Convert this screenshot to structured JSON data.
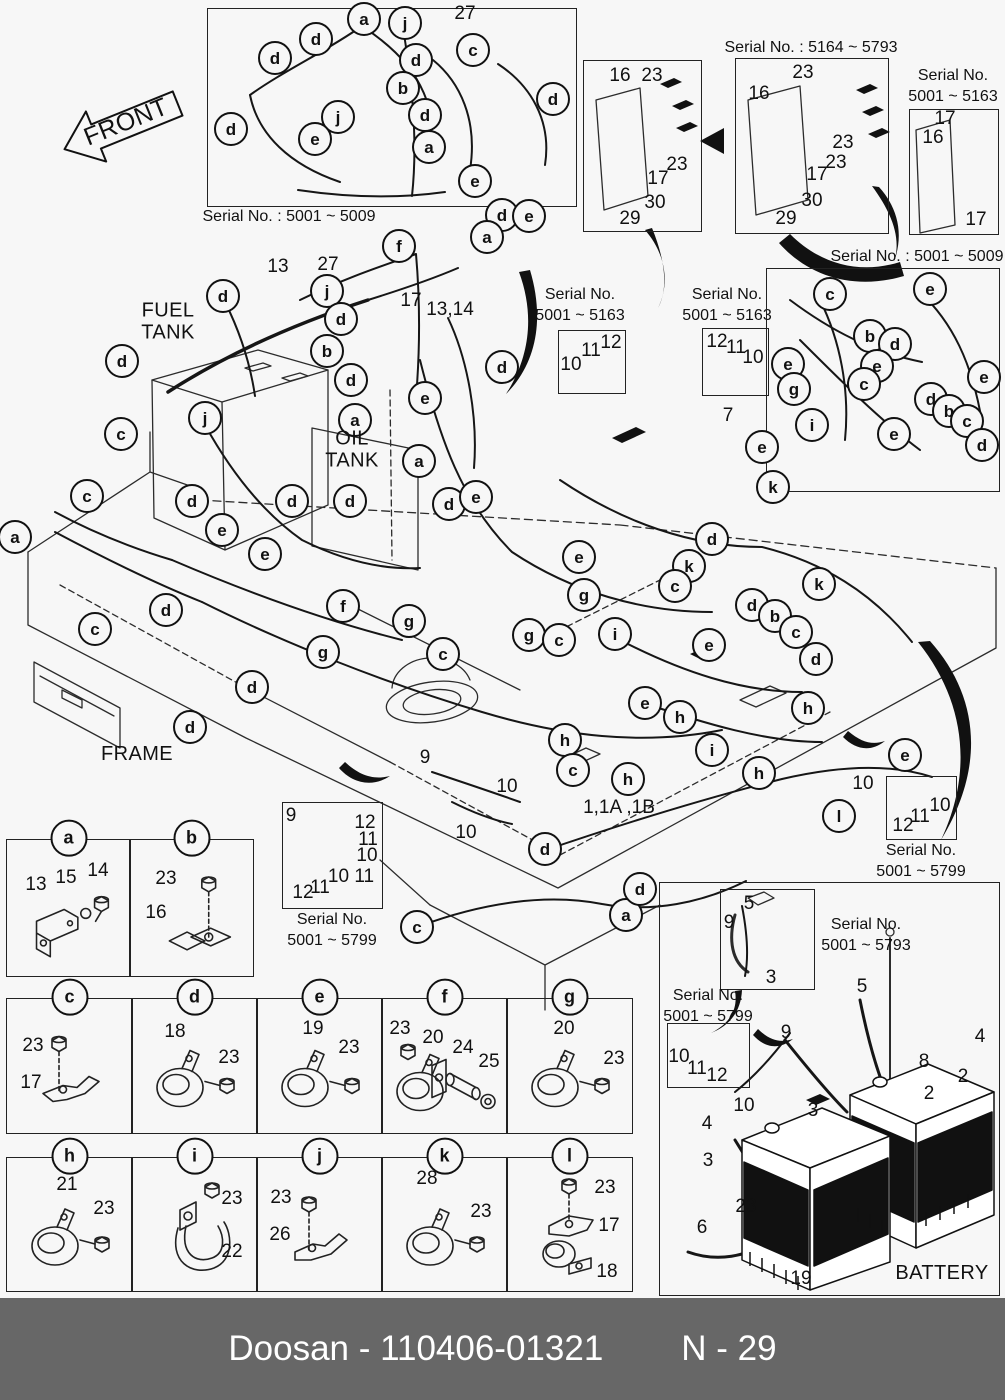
{
  "page": {
    "width": 1005,
    "height": 1400,
    "background": "#f7f7f7",
    "line_color": "#1a1a1a"
  },
  "footer": {
    "brand": "Doosan",
    "figure_number": "110406-01321",
    "left_text": "Doosan - 110406-01321",
    "page_code": "N - 29",
    "bar_color": "#676767",
    "text_color": "#ffffff"
  },
  "area_labels": [
    {
      "id": "front",
      "lines": [
        "FRONT"
      ],
      "x": 126,
      "y": 122,
      "size": 25,
      "rotate": -22
    },
    {
      "id": "fuel-tank",
      "lines": [
        "FUEL",
        "TANK"
      ],
      "x": 168,
      "y": 322,
      "size": 20
    },
    {
      "id": "oil-tank",
      "lines": [
        "OIL",
        "TANK"
      ],
      "x": 352,
      "y": 450,
      "size": 20
    },
    {
      "id": "frame",
      "lines": [
        "FRAME"
      ],
      "x": 137,
      "y": 754,
      "size": 20
    },
    {
      "id": "battery",
      "lines": [
        "BATTERY"
      ],
      "x": 942,
      "y": 1273,
      "size": 20
    }
  ],
  "serial_boxes": [
    {
      "id": "top-left-5009",
      "box": [
        207,
        8,
        368,
        197
      ],
      "caption_lines": [
        "Serial No. : 5001 ~ 5009"
      ],
      "caption_xy": [
        289,
        207
      ]
    },
    {
      "id": "plate-early",
      "box": [
        583,
        60,
        117,
        170
      ]
    },
    {
      "id": "plate-5164-5793",
      "box": [
        735,
        58,
        152,
        174
      ],
      "caption_lines": [
        "Serial No. : 5164 ~ 5793"
      ],
      "caption_xy": [
        811,
        38
      ]
    },
    {
      "id": "top-right-5163",
      "box": [
        909,
        109,
        88,
        124
      ],
      "caption_lines": [
        "Serial No.",
        "5001 ~ 5163"
      ],
      "caption_xy": [
        953,
        66
      ]
    },
    {
      "id": "mid-5163-left",
      "box": [
        558,
        330,
        66,
        62
      ],
      "caption_lines": [
        "Serial No.",
        "5001 ~ 5163"
      ],
      "caption_xy": [
        580,
        285
      ]
    },
    {
      "id": "mid-5163-right",
      "box": [
        702,
        328,
        65,
        66
      ],
      "caption_lines": [
        "Serial No.",
        "5001 ~ 5163"
      ],
      "caption_xy": [
        727,
        285
      ]
    },
    {
      "id": "right-5009",
      "box": [
        766,
        268,
        232,
        222
      ],
      "caption_lines": [
        "Serial No. : 5001 ~ 5009"
      ],
      "caption_xy": [
        917,
        247
      ]
    },
    {
      "id": "center-5799",
      "box": [
        282,
        802,
        99,
        105
      ],
      "caption_lines": [
        "Serial No.",
        "5001 ~ 5799"
      ],
      "caption_xy": [
        332,
        910
      ]
    },
    {
      "id": "right-5799",
      "box": [
        886,
        776,
        69,
        62
      ],
      "caption_lines": [
        "Serial No.",
        "5001 ~ 5799"
      ],
      "caption_xy": [
        921,
        841
      ]
    },
    {
      "id": "battery-outer",
      "box": [
        659,
        882,
        339,
        412
      ]
    },
    {
      "id": "battery-inner-5793",
      "box": [
        720,
        889,
        93,
        99
      ],
      "caption_lines": [
        "Serial No.",
        "5001 ~ 5793"
      ],
      "caption_xy": [
        866,
        915
      ]
    },
    {
      "id": "battery-5799",
      "box": [
        667,
        1023,
        81,
        63
      ],
      "caption_lines": [
        "Serial No.",
        "5001 ~ 5799"
      ],
      "caption_xy": [
        708,
        986
      ]
    }
  ],
  "callouts": [
    {
      "t": "a",
      "x": 362,
      "y": 17
    },
    {
      "t": "j",
      "x": 403,
      "y": 21
    },
    {
      "t": "d",
      "x": 314,
      "y": 37
    },
    {
      "t": "c",
      "x": 471,
      "y": 48
    },
    {
      "t": "d",
      "x": 273,
      "y": 56
    },
    {
      "t": "d",
      "x": 414,
      "y": 58
    },
    {
      "t": "b",
      "x": 401,
      "y": 86
    },
    {
      "t": "d",
      "x": 551,
      "y": 97
    },
    {
      "t": "d",
      "x": 423,
      "y": 113
    },
    {
      "t": "j",
      "x": 336,
      "y": 115
    },
    {
      "t": "d",
      "x": 229,
      "y": 127
    },
    {
      "t": "e",
      "x": 313,
      "y": 137
    },
    {
      "t": "a",
      "x": 427,
      "y": 145
    },
    {
      "t": "e",
      "x": 473,
      "y": 179
    },
    {
      "t": "d",
      "x": 500,
      "y": 213
    },
    {
      "t": "e",
      "x": 527,
      "y": 214
    },
    {
      "t": "a",
      "x": 485,
      "y": 235
    },
    {
      "t": "f",
      "x": 397,
      "y": 244
    },
    {
      "t": "j",
      "x": 325,
      "y": 289
    },
    {
      "t": "d",
      "x": 221,
      "y": 294
    },
    {
      "t": "d",
      "x": 339,
      "y": 317
    },
    {
      "t": "b",
      "x": 325,
      "y": 349
    },
    {
      "t": "d",
      "x": 120,
      "y": 359
    },
    {
      "t": "d",
      "x": 349,
      "y": 378
    },
    {
      "t": "d",
      "x": 500,
      "y": 365
    },
    {
      "t": "e",
      "x": 423,
      "y": 396
    },
    {
      "t": "j",
      "x": 203,
      "y": 416
    },
    {
      "t": "a",
      "x": 353,
      "y": 418
    },
    {
      "t": "c",
      "x": 119,
      "y": 432
    },
    {
      "t": "c",
      "x": 828,
      "y": 292
    },
    {
      "t": "e",
      "x": 928,
      "y": 287
    },
    {
      "t": "b",
      "x": 868,
      "y": 334
    },
    {
      "t": "d",
      "x": 893,
      "y": 342
    },
    {
      "t": "e",
      "x": 786,
      "y": 362
    },
    {
      "t": "e",
      "x": 875,
      "y": 364
    },
    {
      "t": "e",
      "x": 982,
      "y": 375
    },
    {
      "t": "g",
      "x": 792,
      "y": 387
    },
    {
      "t": "c",
      "x": 862,
      "y": 382
    },
    {
      "t": "d",
      "x": 929,
      "y": 397
    },
    {
      "t": "b",
      "x": 947,
      "y": 409
    },
    {
      "t": "c",
      "x": 965,
      "y": 419
    },
    {
      "t": "i",
      "x": 810,
      "y": 423
    },
    {
      "t": "e",
      "x": 892,
      "y": 432
    },
    {
      "t": "d",
      "x": 980,
      "y": 443
    },
    {
      "t": "a",
      "x": 13,
      "y": 535
    },
    {
      "t": "c",
      "x": 85,
      "y": 494
    },
    {
      "t": "d",
      "x": 190,
      "y": 499
    },
    {
      "t": "d",
      "x": 290,
      "y": 499
    },
    {
      "t": "e",
      "x": 220,
      "y": 528
    },
    {
      "t": "e",
      "x": 263,
      "y": 552
    },
    {
      "t": "d",
      "x": 164,
      "y": 608
    },
    {
      "t": "c",
      "x": 93,
      "y": 627
    },
    {
      "t": "g",
      "x": 321,
      "y": 650
    },
    {
      "t": "f",
      "x": 341,
      "y": 604
    },
    {
      "t": "d",
      "x": 250,
      "y": 685
    },
    {
      "t": "d",
      "x": 188,
      "y": 725
    },
    {
      "t": "a",
      "x": 417,
      "y": 459
    },
    {
      "t": "d",
      "x": 447,
      "y": 502
    },
    {
      "t": "e",
      "x": 474,
      "y": 495
    },
    {
      "t": "d",
      "x": 348,
      "y": 499
    },
    {
      "t": "g",
      "x": 407,
      "y": 619
    },
    {
      "t": "g",
      "x": 527,
      "y": 633
    },
    {
      "t": "g",
      "x": 582,
      "y": 593
    },
    {
      "t": "e",
      "x": 577,
      "y": 555
    },
    {
      "t": "c",
      "x": 441,
      "y": 652
    },
    {
      "t": "c",
      "x": 557,
      "y": 638
    },
    {
      "t": "i",
      "x": 613,
      "y": 632
    },
    {
      "t": "h",
      "x": 563,
      "y": 738
    },
    {
      "t": "c",
      "x": 571,
      "y": 768
    },
    {
      "t": "e",
      "x": 760,
      "y": 445
    },
    {
      "t": "k",
      "x": 771,
      "y": 485
    },
    {
      "t": "d",
      "x": 710,
      "y": 537
    },
    {
      "t": "k",
      "x": 687,
      "y": 564
    },
    {
      "t": "c",
      "x": 673,
      "y": 584
    },
    {
      "t": "k",
      "x": 817,
      "y": 582
    },
    {
      "t": "d",
      "x": 750,
      "y": 603
    },
    {
      "t": "b",
      "x": 773,
      "y": 614
    },
    {
      "t": "c",
      "x": 794,
      "y": 630
    },
    {
      "t": "d",
      "x": 814,
      "y": 657
    },
    {
      "t": "e",
      "x": 707,
      "y": 643
    },
    {
      "t": "e",
      "x": 643,
      "y": 701
    },
    {
      "t": "h",
      "x": 678,
      "y": 715
    },
    {
      "t": "h",
      "x": 806,
      "y": 706
    },
    {
      "t": "i",
      "x": 710,
      "y": 748
    },
    {
      "t": "h",
      "x": 757,
      "y": 771
    },
    {
      "t": "h",
      "x": 626,
      "y": 777
    },
    {
      "t": "e",
      "x": 903,
      "y": 753
    },
    {
      "t": "l",
      "x": 837,
      "y": 814
    },
    {
      "t": "c",
      "x": 415,
      "y": 925
    },
    {
      "t": "a",
      "x": 624,
      "y": 913
    },
    {
      "t": "d",
      "x": 543,
      "y": 847
    },
    {
      "t": "d",
      "x": 638,
      "y": 887
    }
  ],
  "part_numbers": [
    {
      "t": "27",
      "x": 465,
      "y": 14
    },
    {
      "t": "13",
      "x": 278,
      "y": 267
    },
    {
      "t": "27",
      "x": 328,
      "y": 265
    },
    {
      "t": "17",
      "x": 411,
      "y": 301
    },
    {
      "t": "13,14",
      "x": 450,
      "y": 310
    },
    {
      "t": "16",
      "x": 620,
      "y": 76
    },
    {
      "t": "23",
      "x": 652,
      "y": 76
    },
    {
      "t": "23",
      "x": 677,
      "y": 165
    },
    {
      "t": "17",
      "x": 658,
      "y": 179
    },
    {
      "t": "30",
      "x": 655,
      "y": 203
    },
    {
      "t": "29",
      "x": 630,
      "y": 219
    },
    {
      "t": "16",
      "x": 759,
      "y": 94
    },
    {
      "t": "23",
      "x": 803,
      "y": 73
    },
    {
      "t": "23",
      "x": 843,
      "y": 143
    },
    {
      "t": "23",
      "x": 836,
      "y": 163
    },
    {
      "t": "17",
      "x": 817,
      "y": 175
    },
    {
      "t": "30",
      "x": 812,
      "y": 201
    },
    {
      "t": "29",
      "x": 786,
      "y": 219
    },
    {
      "t": "17",
      "x": 945,
      "y": 119
    },
    {
      "t": "16",
      "x": 933,
      "y": 138
    },
    {
      "t": "17",
      "x": 976,
      "y": 220
    },
    {
      "t": "10",
      "x": 571,
      "y": 365
    },
    {
      "t": "11",
      "x": 591,
      "y": 351
    },
    {
      "t": "12",
      "x": 611,
      "y": 343
    },
    {
      "t": "12",
      "x": 717,
      "y": 342
    },
    {
      "t": "11",
      "x": 736,
      "y": 348
    },
    {
      "t": "10",
      "x": 753,
      "y": 358
    },
    {
      "t": "7",
      "x": 728,
      "y": 416
    },
    {
      "t": "9",
      "x": 425,
      "y": 758
    },
    {
      "t": "10",
      "x": 507,
      "y": 787
    },
    {
      "t": "10",
      "x": 466,
      "y": 833
    },
    {
      "t": "1,1A ,1B",
      "x": 619,
      "y": 808
    },
    {
      "t": "10",
      "x": 863,
      "y": 784
    },
    {
      "t": "12",
      "x": 903,
      "y": 826
    },
    {
      "t": "11",
      "x": 920,
      "y": 817
    },
    {
      "t": "10",
      "x": 940,
      "y": 806
    },
    {
      "t": "9",
      "x": 291,
      "y": 816
    },
    {
      "t": "12",
      "x": 365,
      "y": 823
    },
    {
      "t": "11",
      "x": 368,
      "y": 840
    },
    {
      "t": "10",
      "x": 367,
      "y": 856
    },
    {
      "t": "10 11",
      "x": 351,
      "y": 877
    },
    {
      "t": "11",
      "x": 320,
      "y": 888
    },
    {
      "t": "12",
      "x": 303,
      "y": 893
    },
    {
      "t": "5",
      "x": 749,
      "y": 904
    },
    {
      "t": "9",
      "x": 729,
      "y": 923
    },
    {
      "t": "3",
      "x": 771,
      "y": 978
    },
    {
      "t": "10",
      "x": 679,
      "y": 1057
    },
    {
      "t": "11",
      "x": 697,
      "y": 1069
    },
    {
      "t": "12",
      "x": 717,
      "y": 1076
    },
    {
      "t": "9",
      "x": 786,
      "y": 1033
    },
    {
      "t": "5",
      "x": 862,
      "y": 987
    },
    {
      "t": "4",
      "x": 980,
      "y": 1037
    },
    {
      "t": "8",
      "x": 924,
      "y": 1062
    },
    {
      "t": "2",
      "x": 963,
      "y": 1077
    },
    {
      "t": "2",
      "x": 929,
      "y": 1094
    },
    {
      "t": "10",
      "x": 744,
      "y": 1106
    },
    {
      "t": "3",
      "x": 813,
      "y": 1111
    },
    {
      "t": "4",
      "x": 707,
      "y": 1124
    },
    {
      "t": "3",
      "x": 708,
      "y": 1161
    },
    {
      "t": "23",
      "x": 746,
      "y": 1207
    },
    {
      "t": "6",
      "x": 702,
      "y": 1228
    },
    {
      "t": "19",
      "x": 801,
      "y": 1279
    }
  ],
  "parts_tables": {
    "rows": [
      {
        "y": 839,
        "h": 136,
        "cells": [
          {
            "letter": "a",
            "x": 6,
            "w": 123,
            "sketch": "bracket_screw",
            "parts": [
              {
                "t": "13",
                "dx": 29,
                "dy": 45
              },
              {
                "t": "15",
                "dx": 59,
                "dy": 38
              },
              {
                "t": "14",
                "dx": 91,
                "dy": 31
              }
            ]
          },
          {
            "letter": "b",
            "x": 129,
            "w": 123,
            "sketch": "plate_bolt",
            "parts": [
              {
                "t": "23",
                "dx": 36,
                "dy": 39
              },
              {
                "t": "16",
                "dx": 26,
                "dy": 73
              }
            ]
          }
        ]
      },
      {
        "y": 998,
        "h": 134,
        "cells": [
          {
            "letter": "c",
            "x": 6,
            "w": 125,
            "sketch": "bolt_bracket",
            "parts": [
              {
                "t": "23",
                "dx": 26,
                "dy": 47
              },
              {
                "t": "17",
                "dx": 24,
                "dy": 84
              }
            ]
          },
          {
            "letter": "d",
            "x": 131,
            "w": 125,
            "sketch": "horn_bolt",
            "parts": [
              {
                "t": "18",
                "dx": 43,
                "dy": 33
              },
              {
                "t": "23",
                "dx": 97,
                "dy": 59
              }
            ]
          },
          {
            "letter": "e",
            "x": 256,
            "w": 125,
            "sketch": "horn_bolt",
            "parts": [
              {
                "t": "19",
                "dx": 56,
                "dy": 30
              },
              {
                "t": "23",
                "dx": 92,
                "dy": 49
              }
            ]
          },
          {
            "letter": "f",
            "x": 381,
            "w": 125,
            "sketch": "horn_spacer",
            "parts": [
              {
                "t": "23",
                "dx": 18,
                "dy": 30
              },
              {
                "t": "20",
                "dx": 51,
                "dy": 39
              },
              {
                "t": "24",
                "dx": 81,
                "dy": 49
              },
              {
                "t": "25",
                "dx": 107,
                "dy": 63
              }
            ]
          },
          {
            "letter": "g",
            "x": 506,
            "w": 125,
            "sketch": "horn_bolt",
            "parts": [
              {
                "t": "20",
                "dx": 57,
                "dy": 30
              },
              {
                "t": "23",
                "dx": 107,
                "dy": 60
              }
            ]
          }
        ]
      },
      {
        "y": 1157,
        "h": 133,
        "cells": [
          {
            "letter": "h",
            "x": 6,
            "w": 125,
            "sketch": "horn_bolt",
            "parts": [
              {
                "t": "21",
                "dx": 60,
                "dy": 27
              },
              {
                "t": "23",
                "dx": 97,
                "dy": 51
              }
            ]
          },
          {
            "letter": "i",
            "x": 131,
            "w": 125,
            "sketch": "bolt_uclamp",
            "parts": [
              {
                "t": "23",
                "dx": 100,
                "dy": 41
              },
              {
                "t": "22",
                "dx": 100,
                "dy": 94
              }
            ]
          },
          {
            "letter": "j",
            "x": 256,
            "w": 125,
            "sketch": "bolt_bracket_arm",
            "parts": [
              {
                "t": "23",
                "dx": 24,
                "dy": 40
              },
              {
                "t": "26",
                "dx": 23,
                "dy": 77
              }
            ]
          },
          {
            "letter": "k",
            "x": 381,
            "w": 125,
            "sketch": "horn_bolt",
            "parts": [
              {
                "t": "28",
                "dx": 45,
                "dy": 21
              },
              {
                "t": "23",
                "dx": 99,
                "dy": 54
              }
            ]
          },
          {
            "letter": "l",
            "x": 506,
            "w": 125,
            "sketch": "bolt_bracket_clamp",
            "parts": [
              {
                "t": "23",
                "dx": 98,
                "dy": 30
              },
              {
                "t": "17",
                "dx": 102,
                "dy": 68
              },
              {
                "t": "18",
                "dx": 100,
                "dy": 114
              }
            ]
          }
        ]
      }
    ]
  }
}
